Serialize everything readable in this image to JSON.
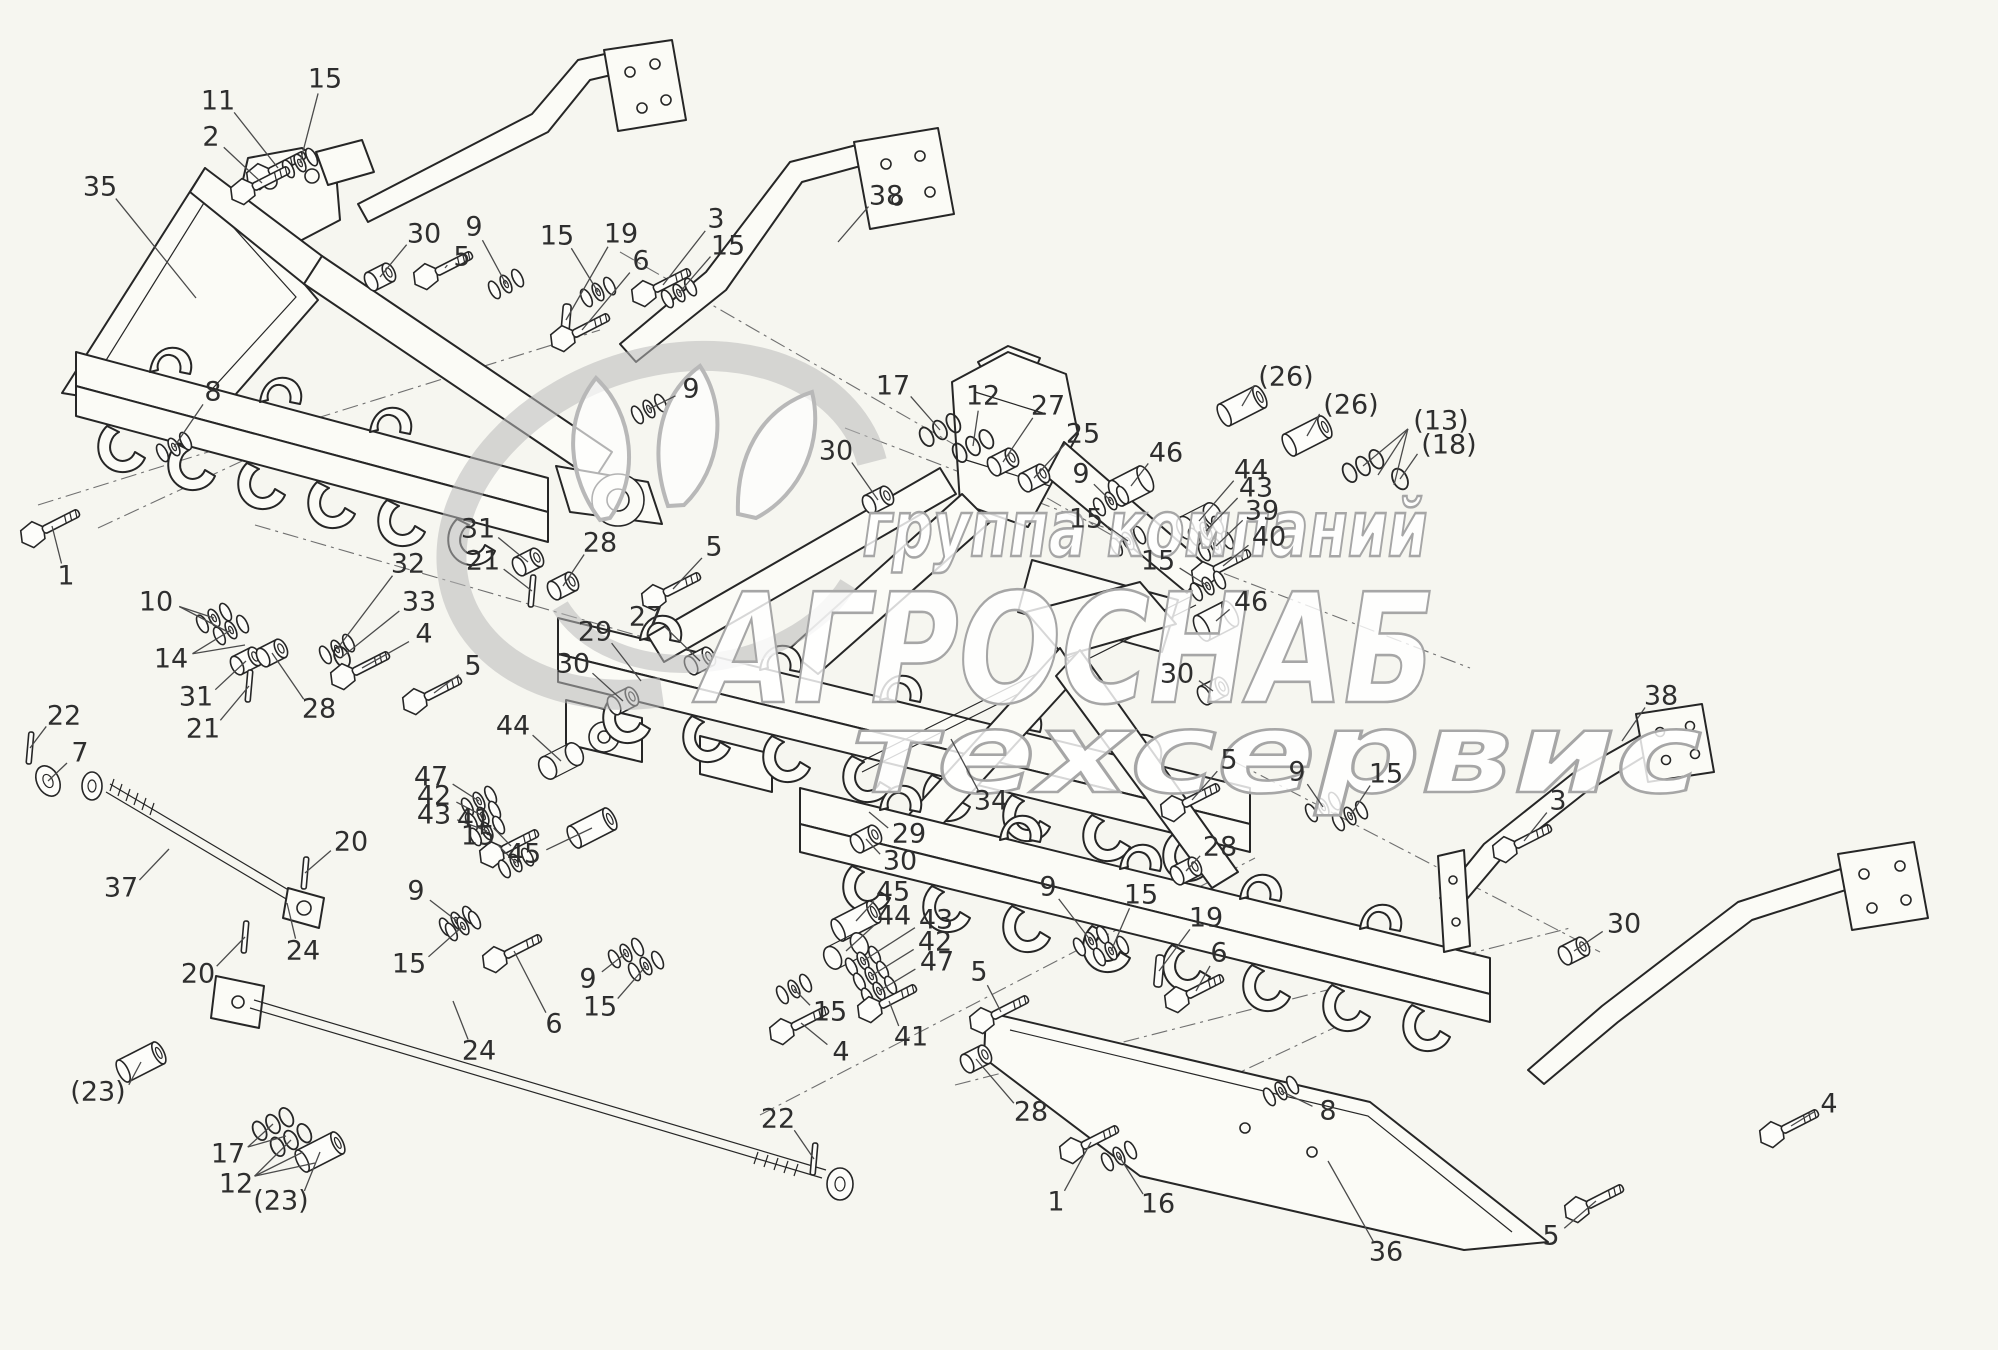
{
  "colors": {
    "background": "#f6f6f0",
    "line": "#262626",
    "watermark": "#a6a6a6",
    "callout_text": "#2e2e2e"
  },
  "watermark": {
    "line1": "группа компаний",
    "line2": "АГРОСНАБ",
    "line3": "техсервис"
  },
  "hardware_types": {
    "bolt": [
      "1",
      "2",
      "3",
      "4",
      "5",
      "6",
      "11",
      "40",
      "41"
    ],
    "washers": [
      "8",
      "9",
      "10",
      "14",
      "15",
      "16",
      "32",
      "39",
      "42",
      "43",
      "47"
    ],
    "rings": [
      "12",
      "13",
      "17"
    ],
    "ring": [
      "18",
      "33"
    ],
    "bushing": [
      "25",
      "27",
      "28",
      "30",
      "31"
    ],
    "roller": [
      "46"
    ],
    "sleeve": [
      "23",
      "26",
      "45"
    ],
    "link": [
      "44"
    ],
    "pin": [
      "20",
      "21",
      "22"
    ],
    "key": [
      "19"
    ],
    "bigwasher": [
      "7"
    ]
  },
  "callouts": [
    {
      "label": "11",
      "tx": 218,
      "ty": 102,
      "ex": 278,
      "ey": 168
    },
    {
      "label": "15",
      "tx": 325,
      "ty": 80,
      "ex": 300,
      "ey": 163
    },
    {
      "label": "2",
      "tx": 211,
      "ty": 138,
      "ex": 262,
      "ey": 183
    },
    {
      "label": "35",
      "tx": 100,
      "ty": 188,
      "ex": 196,
      "ey": 298
    },
    {
      "label": "30",
      "tx": 424,
      "ty": 235,
      "ex": 380,
      "ey": 277
    },
    {
      "label": "9",
      "tx": 474,
      "ty": 228,
      "ex": 506,
      "ey": 284
    },
    {
      "label": "5",
      "tx": 462,
      "ty": 258,
      "ex": 445,
      "ey": 268
    },
    {
      "label": "15",
      "tx": 557,
      "ty": 237,
      "ex": 598,
      "ey": 292
    },
    {
      "label": "19",
      "tx": 621,
      "ty": 235,
      "ex": 566,
      "ey": 320
    },
    {
      "label": "6",
      "tx": 641,
      "ty": 262,
      "ex": 582,
      "ey": 330
    },
    {
      "label": "3",
      "tx": 716,
      "ty": 220,
      "ex": 663,
      "ey": 285
    },
    {
      "label": "15",
      "tx": 728,
      "ty": 247,
      "ex": 679,
      "ey": 293
    },
    {
      "label": "38",
      "tx": 886,
      "ty": 197,
      "ex": 838,
      "ey": 242
    },
    {
      "label": "8",
      "tx": 213,
      "ty": 393,
      "ex": 174,
      "ey": 447
    },
    {
      "label": "1",
      "tx": 66,
      "ty": 577,
      "ex": 52,
      "ey": 526
    },
    {
      "label": "10",
      "tx": 156,
      "ty": 603,
      "ex": 214,
      "ey": 618,
      "fan": [
        [
          228,
          632
        ]
      ]
    },
    {
      "label": "14",
      "tx": 171,
      "ty": 660,
      "ex": 231,
      "ey": 630,
      "fan": [
        [
          245,
          645
        ]
      ]
    },
    {
      "label": "31",
      "tx": 196,
      "ty": 698,
      "ex": 246,
      "ey": 661
    },
    {
      "label": "21",
      "tx": 203,
      "ty": 730,
      "ex": 249,
      "ey": 686
    },
    {
      "label": "28",
      "tx": 319,
      "ty": 710,
      "ex": 272,
      "ey": 653
    },
    {
      "label": "32",
      "tx": 408,
      "ty": 565,
      "ex": 337,
      "ey": 649
    },
    {
      "label": "33",
      "tx": 419,
      "ty": 603,
      "ex": 342,
      "ey": 657
    },
    {
      "label": "4",
      "tx": 424,
      "ty": 635,
      "ex": 362,
      "ey": 668
    },
    {
      "label": "5",
      "tx": 473,
      "ty": 667,
      "ex": 434,
      "ey": 693
    },
    {
      "label": "22",
      "tx": 64,
      "ty": 717,
      "ex": 30,
      "ey": 748
    },
    {
      "label": "7",
      "tx": 80,
      "ty": 754,
      "ex": 48,
      "ey": 781
    },
    {
      "label": "37",
      "tx": 121,
      "ty": 889,
      "ex": 169,
      "ey": 849
    },
    {
      "label": "20",
      "tx": 351,
      "ty": 843,
      "ex": 305,
      "ey": 873
    },
    {
      "label": "24",
      "tx": 303,
      "ty": 952,
      "ex": 287,
      "ey": 903
    },
    {
      "label": "20",
      "tx": 198,
      "ty": 975,
      "ex": 245,
      "ey": 937
    },
    {
      "label": "(23)",
      "tx": 98,
      "ty": 1093,
      "ex": 141,
      "ey": 1062
    },
    {
      "label": "17",
      "tx": 228,
      "ty": 1155,
      "ex": 273,
      "ey": 1124,
      "fan": [
        [
          286,
          1136
        ]
      ]
    },
    {
      "label": "12",
      "tx": 236,
      "ty": 1185,
      "ex": 291,
      "ey": 1140,
      "fan": [
        [
          303,
          1152
        ],
        [
          315,
          1163
        ]
      ]
    },
    {
      "label": "(23)",
      "tx": 281,
      "ty": 1202,
      "ex": 320,
      "ey": 1152
    },
    {
      "label": "9",
      "tx": 691,
      "ty": 390,
      "ex": 649,
      "ey": 409
    },
    {
      "label": "17",
      "tx": 893,
      "ty": 387,
      "ex": 940,
      "ey": 430
    },
    {
      "label": "12",
      "tx": 983,
      "ty": 397,
      "ex": 973,
      "ey": 446
    },
    {
      "label": "27",
      "tx": 1048,
      "ty": 407,
      "ex": 1003,
      "ey": 462
    },
    {
      "label": "25",
      "tx": 1083,
      "ty": 435,
      "ex": 1034,
      "ey": 478
    },
    {
      "label": "30",
      "tx": 836,
      "ty": 452,
      "ex": 878,
      "ey": 500
    },
    {
      "label": "5",
      "tx": 714,
      "ty": 548,
      "ex": 673,
      "ey": 589
    },
    {
      "label": "31",
      "tx": 478,
      "ty": 530,
      "ex": 528,
      "ey": 562
    },
    {
      "label": "21",
      "tx": 483,
      "ty": 562,
      "ex": 532,
      "ey": 591
    },
    {
      "label": "28",
      "tx": 600,
      "ty": 544,
      "ex": 563,
      "ey": 586
    },
    {
      "label": "27",
      "tx": 646,
      "ty": 618,
      "ex": 700,
      "ey": 661
    },
    {
      "label": "29",
      "tx": 595,
      "ty": 633,
      "ex": 641,
      "ey": 681
    },
    {
      "label": "30",
      "tx": 573,
      "ty": 665,
      "ex": 623,
      "ey": 701
    },
    {
      "label": "44",
      "tx": 513,
      "ty": 727,
      "ex": 561,
      "ey": 761
    },
    {
      "label": "47",
      "tx": 431,
      "ty": 778,
      "ex": 479,
      "ey": 801
    },
    {
      "label": "42",
      "tx": 434,
      "ty": 797,
      "ex": 483,
      "ey": 816
    },
    {
      "label": "43",
      "tx": 434,
      "ty": 816,
      "ex": 487,
      "ey": 831
    },
    {
      "label": "41",
      "tx": 474,
      "ty": 820,
      "ex": 511,
      "ey": 846
    },
    {
      "label": "15",
      "tx": 478,
      "ty": 837,
      "ex": 516,
      "ey": 863
    },
    {
      "label": "45",
      "tx": 524,
      "ty": 855,
      "ex": 592,
      "ey": 828
    },
    {
      "label": "9",
      "tx": 416,
      "ty": 892,
      "ex": 457,
      "ey": 921
    },
    {
      "label": "15",
      "tx": 409,
      "ty": 965,
      "ex": 463,
      "ey": 926
    },
    {
      "label": "6",
      "tx": 554,
      "ty": 1025,
      "ex": 514,
      "ey": 951
    },
    {
      "label": "24",
      "tx": 479,
      "ty": 1052,
      "ex": 453,
      "ey": 1001
    },
    {
      "label": "9",
      "tx": 588,
      "ty": 980,
      "ex": 626,
      "ey": 953
    },
    {
      "label": "15",
      "tx": 600,
      "ty": 1008,
      "ex": 646,
      "ey": 966
    },
    {
      "label": "22",
      "tx": 778,
      "ty": 1120,
      "ex": 814,
      "ey": 1159
    },
    {
      "label": "4",
      "tx": 841,
      "ty": 1053,
      "ex": 801,
      "ey": 1023
    },
    {
      "label": "15",
      "tx": 830,
      "ty": 1013,
      "ex": 794,
      "ey": 989
    },
    {
      "label": "45",
      "tx": 893,
      "ty": 893,
      "ex": 856,
      "ey": 921
    },
    {
      "label": "44",
      "tx": 894,
      "ty": 917,
      "ex": 846,
      "ey": 951
    },
    {
      "label": "43",
      "tx": 936,
      "ty": 921,
      "ex": 863,
      "ey": 961
    },
    {
      "label": "42",
      "tx": 935,
      "ty": 943,
      "ex": 871,
      "ey": 976
    },
    {
      "label": "47",
      "tx": 937,
      "ty": 963,
      "ex": 879,
      "ey": 991
    },
    {
      "label": "41",
      "tx": 911,
      "ty": 1038,
      "ex": 889,
      "ey": 1001
    },
    {
      "label": "5",
      "tx": 979,
      "ty": 973,
      "ex": 1001,
      "ey": 1012
    },
    {
      "label": "28",
      "tx": 1031,
      "ty": 1113,
      "ex": 976,
      "ey": 1059
    },
    {
      "label": "34",
      "tx": 991,
      "ty": 802,
      "ex": 951,
      "ey": 739
    },
    {
      "label": "29",
      "tx": 909,
      "ty": 835,
      "ex": 869,
      "ey": 812
    },
    {
      "label": "30",
      "tx": 900,
      "ty": 862,
      "ex": 866,
      "ey": 839
    },
    {
      "label": "1",
      "tx": 1056,
      "ty": 1203,
      "ex": 1091,
      "ey": 1142
    },
    {
      "label": "16",
      "tx": 1158,
      "ty": 1205,
      "ex": 1119,
      "ey": 1156
    },
    {
      "label": "36",
      "tx": 1386,
      "ty": 1253,
      "ex": 1328,
      "ey": 1161
    },
    {
      "label": "8",
      "tx": 1328,
      "ty": 1112,
      "ex": 1281,
      "ey": 1091
    },
    {
      "label": "9",
      "tx": 1048,
      "ty": 888,
      "ex": 1091,
      "ey": 941
    },
    {
      "label": "15",
      "tx": 1141,
      "ty": 896,
      "ex": 1111,
      "ey": 951
    },
    {
      "label": "19",
      "tx": 1206,
      "ty": 919,
      "ex": 1159,
      "ey": 971
    },
    {
      "label": "6",
      "tx": 1219,
      "ty": 954,
      "ex": 1196,
      "ey": 991
    },
    {
      "label": "46",
      "tx": 1166,
      "ty": 454,
      "ex": 1131,
      "ey": 486
    },
    {
      "label": "9",
      "tx": 1081,
      "ty": 475,
      "ex": 1111,
      "ey": 501
    },
    {
      "label": "15",
      "tx": 1086,
      "ty": 520,
      "ex": 1128,
      "ey": 541
    },
    {
      "label": "44",
      "tx": 1251,
      "ty": 471,
      "ex": 1199,
      "ey": 521
    },
    {
      "label": "43",
      "tx": 1256,
      "ty": 489,
      "ex": 1206,
      "ey": 531
    },
    {
      "label": "39",
      "tx": 1262,
      "ty": 512,
      "ex": 1216,
      "ey": 546
    },
    {
      "label": "40",
      "tx": 1269,
      "ty": 538,
      "ex": 1223,
      "ey": 566
    },
    {
      "label": "15",
      "tx": 1158,
      "ty": 562,
      "ex": 1208,
      "ey": 586
    },
    {
      "label": "46",
      "tx": 1251,
      "ty": 603,
      "ex": 1216,
      "ey": 621
    },
    {
      "label": "30",
      "tx": 1177,
      "ty": 675,
      "ex": 1213,
      "ey": 691
    },
    {
      "label": "(26)",
      "tx": 1286,
      "ty": 378,
      "ex": 1242,
      "ey": 406
    },
    {
      "label": "(26)",
      "tx": 1351,
      "ty": 406,
      "ex": 1307,
      "ey": 436
    },
    {
      "label": "(13)",
      "tx": 1441,
      "ty": 422,
      "ex": 1363,
      "ey": 466,
      "fan": [
        [
          1378,
          475
        ],
        [
          1394,
          485
        ]
      ]
    },
    {
      "label": "(18)",
      "tx": 1449,
      "ty": 446,
      "ex": 1400,
      "ey": 479
    },
    {
      "label": "5",
      "tx": 1229,
      "ty": 761,
      "ex": 1192,
      "ey": 800
    },
    {
      "label": "9",
      "tx": 1297,
      "ty": 773,
      "ex": 1323,
      "ey": 807
    },
    {
      "label": "15",
      "tx": 1386,
      "ty": 775,
      "ex": 1350,
      "ey": 816
    },
    {
      "label": "28",
      "tx": 1220,
      "ty": 848,
      "ex": 1186,
      "ey": 871
    },
    {
      "label": "38",
      "tx": 1661,
      "ty": 697,
      "ex": 1622,
      "ey": 741
    },
    {
      "label": "3",
      "tx": 1558,
      "ty": 802,
      "ex": 1524,
      "ey": 841
    },
    {
      "label": "30",
      "tx": 1624,
      "ty": 925,
      "ex": 1574,
      "ey": 951
    },
    {
      "label": "4",
      "tx": 1829,
      "ty": 1105,
      "ex": 1791,
      "ey": 1126
    },
    {
      "label": "5",
      "tx": 1551,
      "ty": 1237,
      "ex": 1596,
      "ey": 1201
    }
  ]
}
